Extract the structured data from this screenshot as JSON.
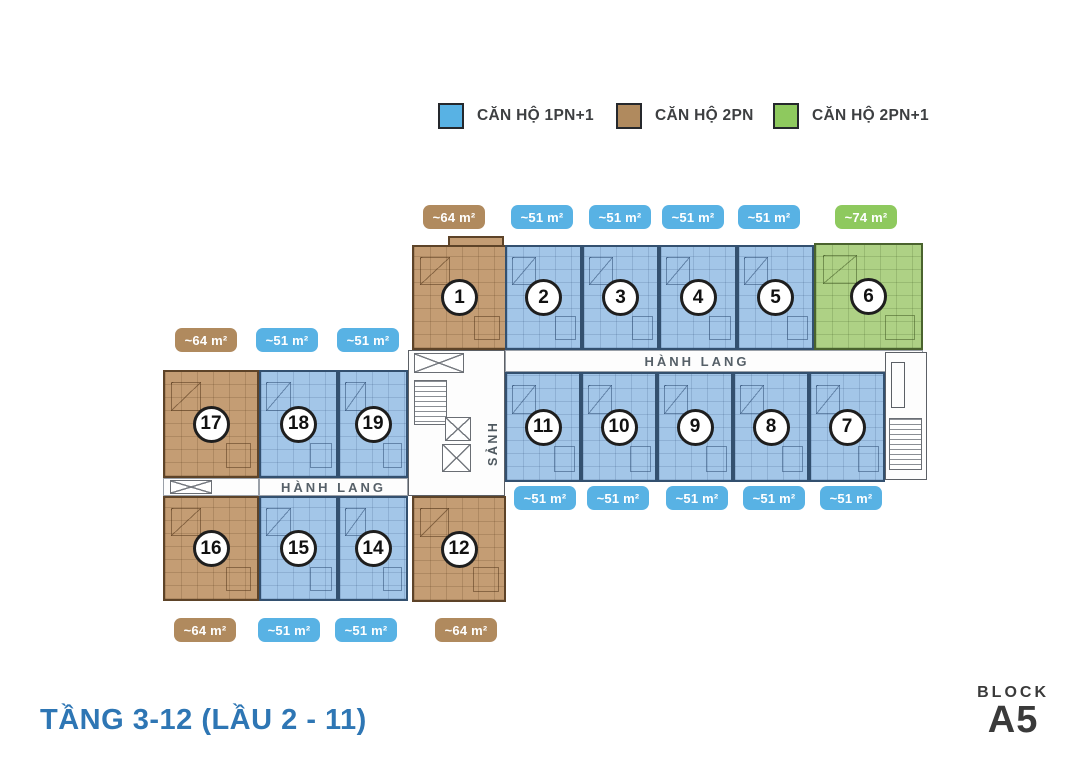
{
  "legend": {
    "items": [
      {
        "label": "CĂN HỘ 1PN+1",
        "color": "#58b2e4",
        "type": "1PN+1"
      },
      {
        "label": "CĂN HỘ 2PN",
        "color": "#b08a5e",
        "type": "2PN"
      },
      {
        "label": "CĂN HỘ 2PN+1",
        "color": "#8ec95e",
        "type": "2PN+1"
      }
    ]
  },
  "plan": {
    "corridor_label": "HÀNH LANG",
    "lobby_label": "SẢNH",
    "units": [
      {
        "number": "1",
        "type": "2PN",
        "area": "~64 m²"
      },
      {
        "number": "2",
        "type": "1PN+1",
        "area": "~51 m²"
      },
      {
        "number": "3",
        "type": "1PN+1",
        "area": "~51 m²"
      },
      {
        "number": "4",
        "type": "1PN+1",
        "area": "~51 m²"
      },
      {
        "number": "5",
        "type": "1PN+1",
        "area": "~51 m²"
      },
      {
        "number": "6",
        "type": "2PN+1",
        "area": "~74 m²"
      },
      {
        "number": "7",
        "type": "1PN+1",
        "area": "~51 m²"
      },
      {
        "number": "8",
        "type": "1PN+1",
        "area": "~51 m²"
      },
      {
        "number": "9",
        "type": "1PN+1",
        "area": "~51 m²"
      },
      {
        "number": "10",
        "type": "1PN+1",
        "area": "~51 m²"
      },
      {
        "number": "11",
        "type": "1PN+1",
        "area": "~51 m²"
      },
      {
        "number": "12",
        "type": "2PN",
        "area": "~64 m²"
      },
      {
        "number": "14",
        "type": "1PN+1",
        "area": "~51 m²"
      },
      {
        "number": "15",
        "type": "1PN+1",
        "area": "~51 m²"
      },
      {
        "number": "16",
        "type": "2PN",
        "area": "~64 m²"
      },
      {
        "number": "17",
        "type": "2PN",
        "area": "~64 m²"
      },
      {
        "number": "18",
        "type": "1PN+1",
        "area": "~51 m²"
      },
      {
        "number": "19",
        "type": "1PN+1",
        "area": "~51 m²"
      }
    ],
    "badges": {
      "top": [
        "~64 m²",
        "~51 m²",
        "~51 m²",
        "~51 m²",
        "~51 m²",
        "~74 m²"
      ],
      "left_top": [
        "~64 m²",
        "~51 m²",
        "~51 m²"
      ],
      "mid": [
        "~51 m²",
        "~51 m²",
        "~51 m²",
        "~51 m²",
        "~51 m²"
      ],
      "bottom": [
        "~64 m²",
        "~51 m²",
        "~51 m²",
        "~64 m²"
      ]
    }
  },
  "footer": {
    "floor_title": "TẦNG 3-12 (LẦU 2 - 11)",
    "block_label": "BLOCK",
    "block_name": "A5"
  },
  "colors": {
    "unit_1pn1_fill": "#a3c6e8",
    "unit_2pn_fill": "#c49d74",
    "unit_2pn1_fill": "#aed185",
    "badge_blue": "#58b2e4",
    "badge_brown": "#b08a5e",
    "badge_green": "#8ec95e",
    "title_blue": "#2e76b4",
    "block_text": "#3a3a3a"
  }
}
